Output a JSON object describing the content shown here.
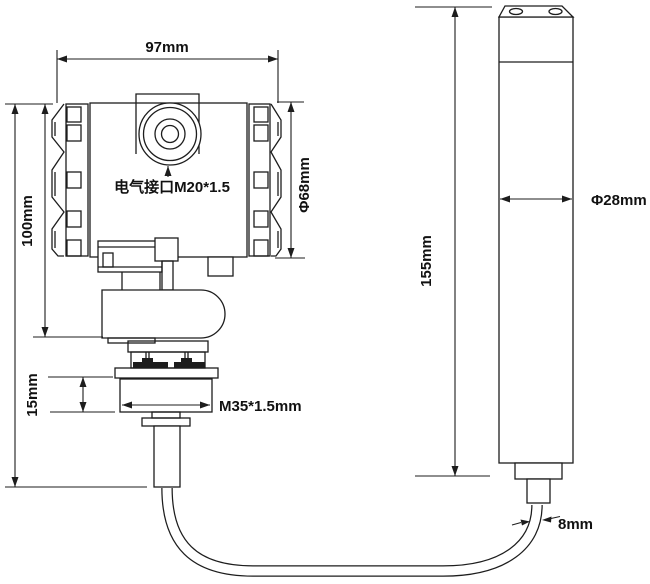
{
  "drawing": {
    "type": "technical-dimension-diagram",
    "stroke_color": "#1d1d1d",
    "text_color": "#111111",
    "background": "#ffffff",
    "transmitter": {
      "width_label": "97mm",
      "height_label": "100mm",
      "housing_diameter_label": "Φ68mm",
      "electrical_port_label": "电气接口M20*1.5",
      "nut_height_label": "15mm",
      "thread_label": "M35*1.5mm"
    },
    "probe": {
      "length_label": "155mm",
      "diameter_label": "Φ28mm"
    },
    "cable": {
      "diameter_label": "8mm"
    }
  }
}
